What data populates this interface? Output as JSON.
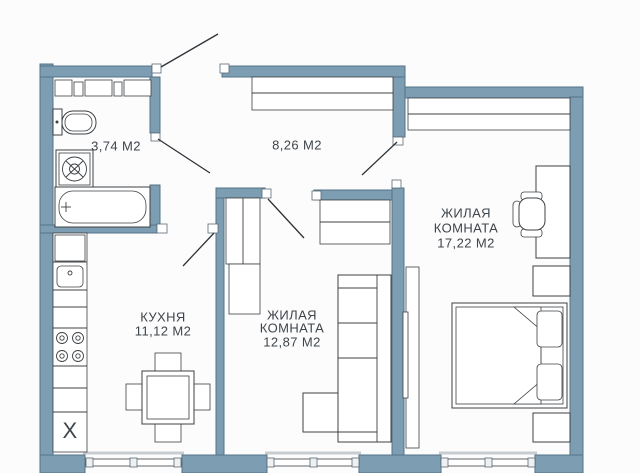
{
  "plan": {
    "type": "apartment-floor-plan",
    "rooms": [
      {
        "id": "bathroom",
        "lines": [
          "3,74 М2"
        ]
      },
      {
        "id": "hallway",
        "lines": [
          "8,26 М2"
        ]
      },
      {
        "id": "kitchen",
        "lines": [
          "КУХНЯ",
          "11,12 М2"
        ]
      },
      {
        "id": "living-room-1",
        "lines": [
          "ЖИЛАЯ",
          "КОМНАТА",
          "12,87 М2"
        ]
      },
      {
        "id": "living-room-2",
        "lines": [
          "ЖИЛАЯ",
          "КОМНАТА",
          "17,22 М2"
        ]
      }
    ],
    "kitchen_fridge_mark": "X",
    "colors": {
      "wall": "#7C9DB2",
      "wall-stroke": "#54748A",
      "line": "#3C4043",
      "text": "#3E454B",
      "background": "#FCFCFC"
    }
  }
}
